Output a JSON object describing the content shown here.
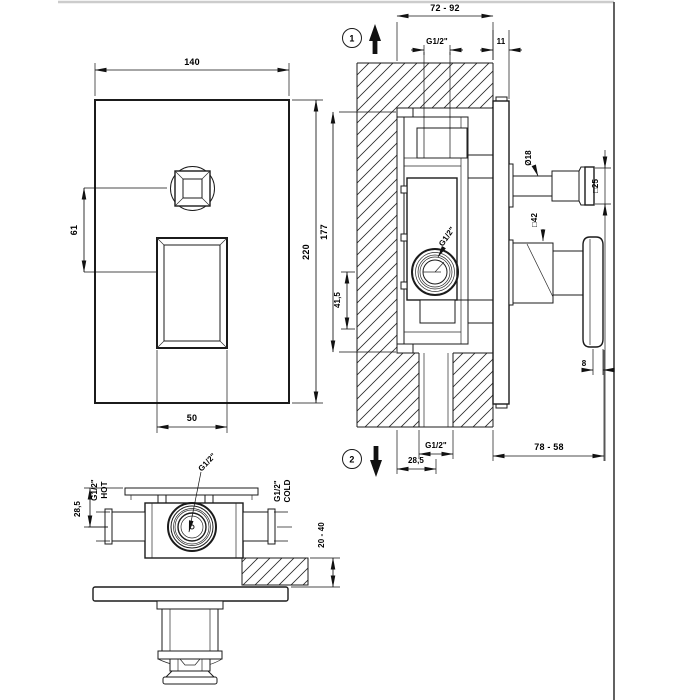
{
  "drawing": {
    "kind": "technical installation drawing",
    "colors": {
      "line": "#1b1b1b",
      "frame": "#3a3a3a",
      "top_rule": "#cccccc"
    }
  },
  "labels": {
    "front": {
      "width": "140",
      "height": "220",
      "handle_width": "50",
      "axis_offset": "61"
    },
    "section": {
      "marker_top": "1",
      "marker_bottom": "2",
      "depth_range_top": "72 - 92",
      "plate_proud": "11",
      "outlet_top": "G1/2\"",
      "box_height": "177",
      "outlet_offset": "41,5",
      "outlet_side": "G1/2\"",
      "outlet_bottom": "G1/2\"",
      "inlet_offset": "28,5",
      "depth_range_bottom": "78 - 58",
      "stem_diameter": "Ø18",
      "knob_square": "□25",
      "base_square": "□42",
      "paddle_thickness": "8"
    },
    "bottom": {
      "g_hot": "G1/2\"",
      "hot": "HOT",
      "g_cold": "G1/2\"",
      "cold": "COLD",
      "g_center": "G1/2\"",
      "flange_offset": "28,5",
      "wall_range": "20 - 40"
    }
  }
}
